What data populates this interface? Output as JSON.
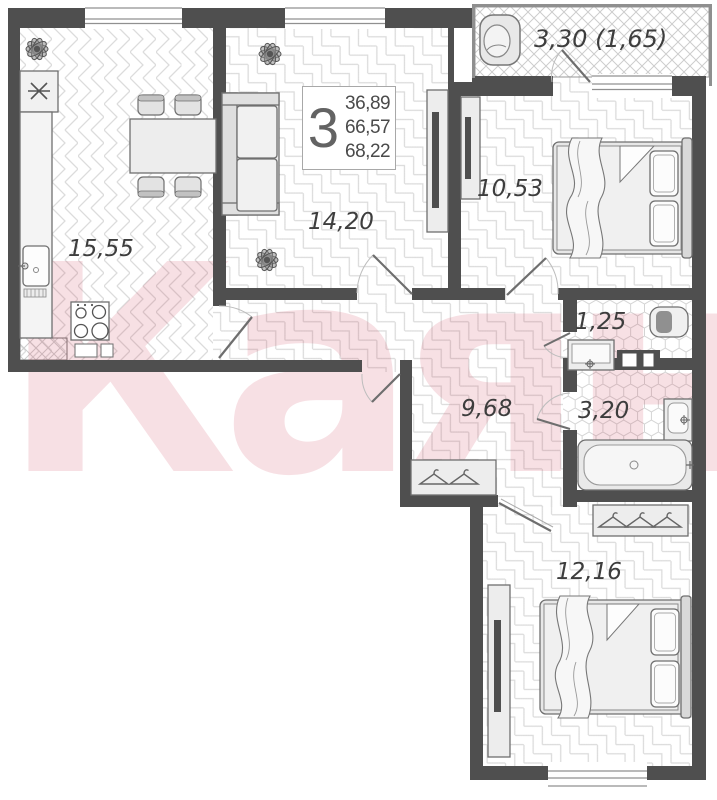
{
  "watermark_text": "Каян",
  "info_box": {
    "rooms_count": "3",
    "living_area": "36,89",
    "area_without_balcony": "66,57",
    "total_area": "68,22"
  },
  "rooms": {
    "kitchen": "15,55",
    "living_room": "14,20",
    "bedroom_top": "10,53",
    "balcony": "3,30 (1,65)",
    "toilet": "1,25",
    "bathroom": "3,20",
    "hallway": "9,68",
    "bedroom_bottom": "12,16"
  },
  "colors": {
    "wall": "#4f4f4f",
    "floor_pattern_line": "#dcdcdc",
    "hex_pattern_line": "#d4d4d4",
    "watermark_pink": "rgba(206,60,90,0.16)",
    "furniture_stroke": "#6f6f6f",
    "label_text": "#3d3d3d"
  }
}
